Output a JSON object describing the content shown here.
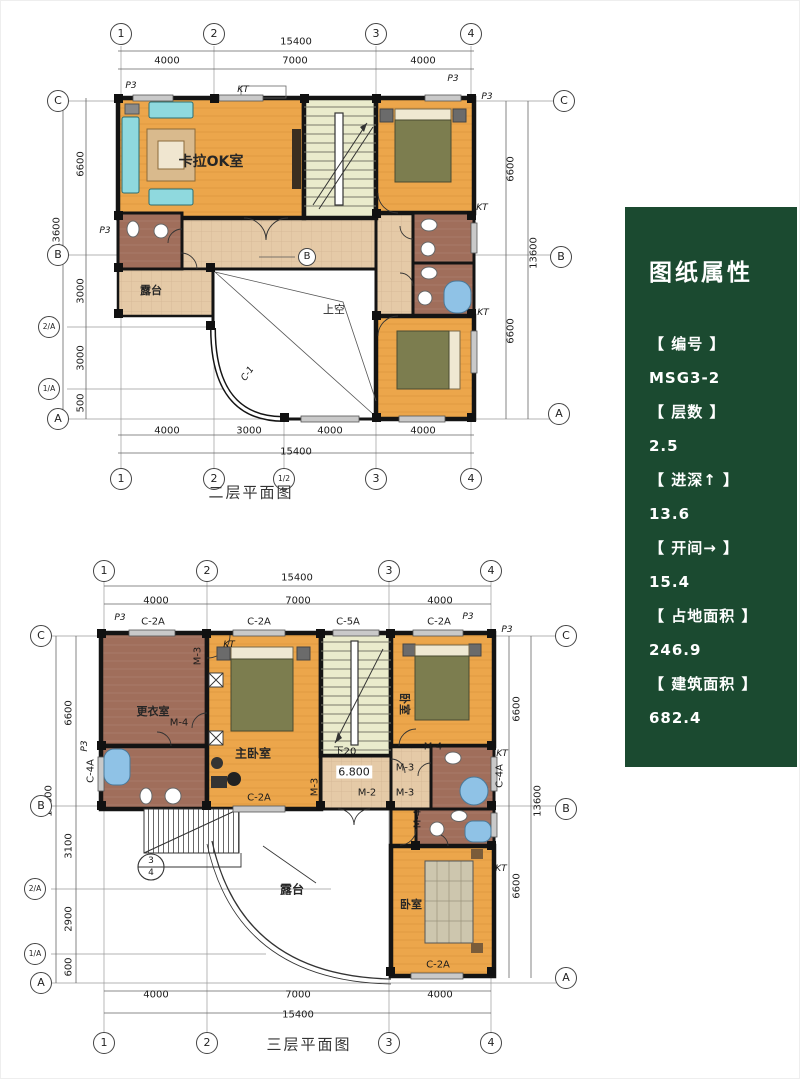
{
  "panel": {
    "title": "图纸属性",
    "fields": [
      {
        "label": "【 编号 】",
        "value": "MSG3-2"
      },
      {
        "label": "【 层数 】",
        "value": "2.5"
      },
      {
        "label": "【 进深↑ 】",
        "value": "13.6"
      },
      {
        "label": "【 开间→ 】",
        "value": "15.4"
      },
      {
        "label": "【 占地面积 】",
        "value": "246.9"
      },
      {
        "label": "【 建筑面积 】",
        "value": "682.4"
      }
    ],
    "bg_color": "#1B4A30"
  },
  "plan2f": {
    "caption": "二层平面图",
    "grid": {
      "top": [
        "1",
        "2",
        "3",
        "4"
      ],
      "bottom": [
        "1",
        "2",
        "1/2",
        "3",
        "4"
      ],
      "left": [
        "C",
        "B",
        "2/A",
        "1/A",
        "A"
      ],
      "right": [
        "C",
        "B",
        "A"
      ],
      "mid": "B"
    },
    "dims": {
      "top_total": "15400",
      "top": [
        "4000",
        "7000",
        "4000"
      ],
      "bottom": [
        "4000",
        "3000",
        "4000",
        "4000"
      ],
      "bottom_total": "15400",
      "left": [
        "6600",
        "3000",
        "3000",
        "500"
      ],
      "left_total": "13600",
      "right": [
        "6600",
        "6600"
      ],
      "right_total": "13600"
    },
    "rooms": {
      "karaoke": "卡拉OK室",
      "terrace": "露台",
      "void_above": "上空"
    },
    "codes": {
      "p3": "P3",
      "kt": "KT",
      "c1": "C-1"
    }
  },
  "plan3f": {
    "caption": "三层平面图",
    "grid": {
      "top": [
        "1",
        "2",
        "3",
        "4"
      ],
      "bottom": [
        "1",
        "2",
        "3",
        "4"
      ],
      "left": [
        "C",
        "B",
        "2/A",
        "1/A",
        "A"
      ],
      "right": [
        "C",
        "B",
        "A"
      ],
      "detail_top": "3",
      "detail_bottom": "4"
    },
    "dims": {
      "top_total": "15400",
      "top": [
        "4000",
        "7000",
        "4000"
      ],
      "bottom": [
        "4000",
        "7000",
        "4000"
      ],
      "bottom_total": "15400",
      "left": [
        "6600",
        "3100",
        "2900",
        "600"
      ],
      "left_total": "13600",
      "right": [
        "6600",
        "6600"
      ],
      "right_total": "13600"
    },
    "rooms": {
      "dressing": "更衣室",
      "master": "主卧室",
      "bedroom_top": "卧室",
      "bedroom_bottom": "卧室",
      "terrace": "露台"
    },
    "codes": {
      "p3": "P3",
      "kt": "KT",
      "c2a": "C-2A",
      "c5a": "C-5A",
      "c4a": "C-4A",
      "m2": "M-2",
      "m3": "M-3",
      "m4": "M-4"
    },
    "elevation": "6.800",
    "stair_note": "下20"
  }
}
